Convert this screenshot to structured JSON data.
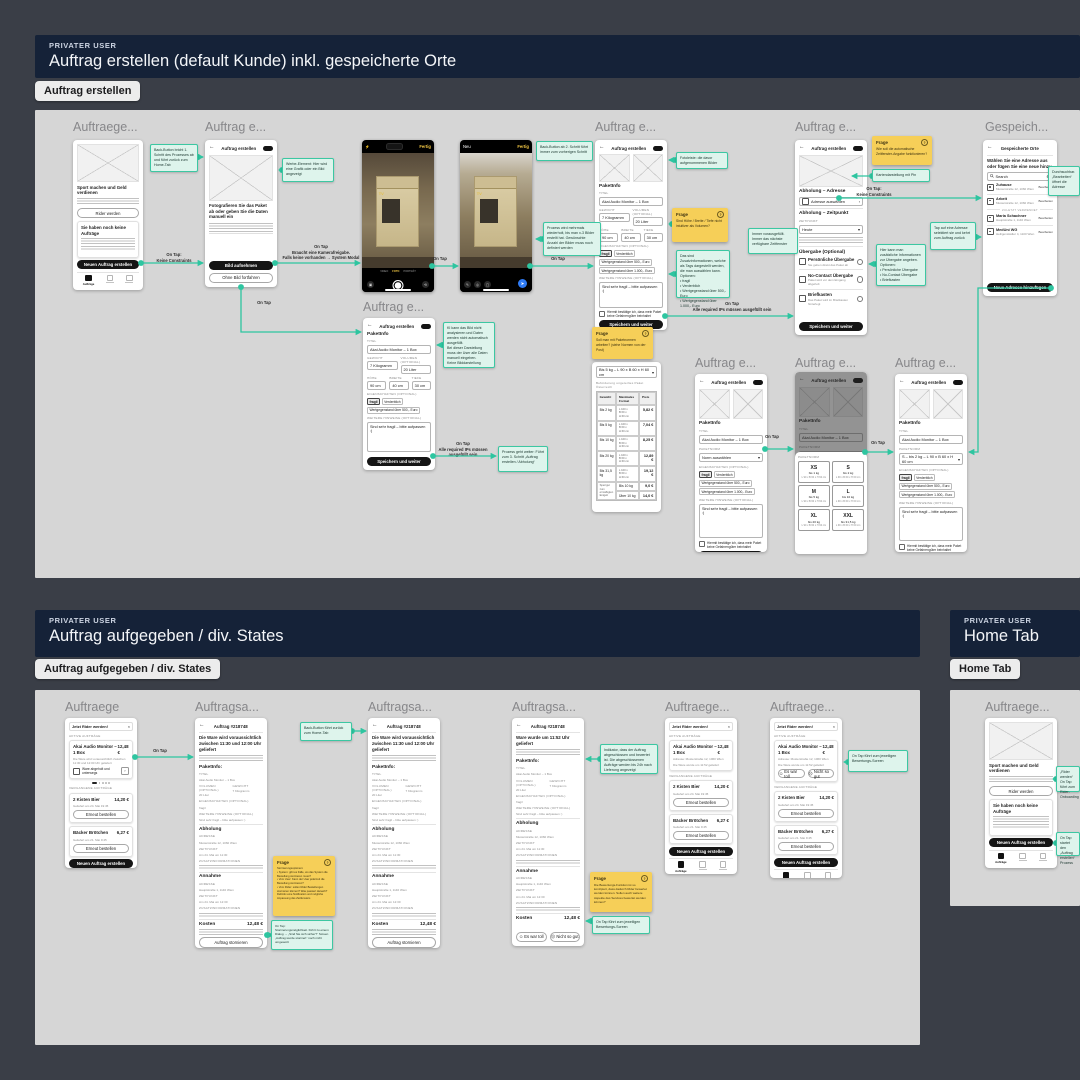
{
  "sec": {
    "s1": {
      "eyebrow": "PRIVATER USER",
      "title": "Auftrag erstellen (default Kunde) inkl. gespeicherte Orte",
      "tag": "Auftrag erstellen"
    },
    "s2": {
      "eyebrow": "PRIVATER USER",
      "title": "Auftrag aufgegeben / div. States",
      "tag": "Auftrag aufgegeben / div. States"
    },
    "s3": {
      "eyebrow": "PRIVATER USER",
      "title": "Home Tab",
      "tag": "Home Tab"
    }
  },
  "titles": {
    "auftraege_s": "Auftraege...",
    "auftraege": "Auftraege",
    "auftrag_e": "Auftrag e...",
    "auftragsa": "Auftragsa...",
    "gespeich": "Gespeich..."
  },
  "cam": {
    "fertig": "Fertig",
    "neu": "Neu",
    "foto": "FOTO",
    "video": "VIDEO",
    "portraet": "PORTRÄT",
    "send": "➤",
    "flash": "⚡"
  },
  "fr": {
    "home": {
      "hero": "Sport machen und Geld verdienen",
      "hero_btn": "Rider werden",
      "empty": "Sie haben noch keine Aufträge",
      "cta": "Neuen Auftrag erstellen",
      "tab": "Aufträge"
    },
    "foto": {
      "appbar": "Auftrag erstellen",
      "head": "Fotografieren Sie das Paket ab oder geben Sie die Daten manuell ein",
      "cta": "Bild aufnehmen",
      "alt": "Ohne Bild fortfahren"
    },
    "pk": {
      "appbar": "Auftrag erstellen",
      "sec": "PaketInfo",
      "titel_l": "TITEL",
      "titel": "Akai Audio Monitor – 1 Box",
      "gew_l": "GEWICHT",
      "gew": "7 Kilogramm",
      "vol_l": "VOLUMEN (OPTIONAL)",
      "vol": "20 Liter",
      "hoe_l": "HÖHE",
      "hoe": "90 cm",
      "bre_l": "BREITE",
      "bre": "40 cm",
      "tie_l": "TIEFE",
      "tie": "30 cm",
      "eig_l": "EIGENSCHAFTEN (OPTIONAL)",
      "chips": [
        "fragil",
        "Verderblich",
        "Wertgegenstand über 500,- Euro",
        "Wertgegenstand über 1.000,- Euro"
      ],
      "hin_l": "WEITERE HINWEISE (OPTIONAL)",
      "hin": "Sind sehr fragil – bitte aufpassen :)",
      "chk": "Hiermit bestätige ich, dass mein Paket keine Gefahrengüter beinhaltet",
      "cta": "Speichern und weiter",
      "norm_l": "PAKETNORM",
      "norm_ph": "Norm auswählen",
      "norm_sel": "S – bis 2 kg – L 90 x B 60 x H 60 cm",
      "caret": "▾",
      "chev": "›"
    },
    "sheet": {
      "lbl": "PAKETNORM",
      "cells": [
        {
          "n": "XS",
          "w": "bis 1 kg",
          "d": "L 90 x B 60 x H 60 cm"
        },
        {
          "n": "S",
          "w": "bis 2 kg",
          "d": "L 90 x B 60 x H 60 cm"
        },
        {
          "n": "M",
          "w": "bis 5 kg",
          "d": "L 90 x B 60 x H 60 cm"
        },
        {
          "n": "L",
          "w": "bis 10 kg",
          "d": "L 90 x B 60 x H 60 cm"
        },
        {
          "n": "XL",
          "w": "bis 20 kg",
          "d": "L 90 x B 60 x H 60 cm"
        },
        {
          "n": "XXL",
          "w": "bis 31,5 kg",
          "d": "L 90 x B 60 x H 60 cm"
        }
      ]
    },
    "abh": {
      "appbar": "Auftrag erstellen",
      "sec1": "Abholung – Adresse",
      "row1": "Adresse auswählen",
      "sec2": "Abholung – Zeitpunkt",
      "zeit_l": "ZEITPUNKT",
      "zeit": "Heute",
      "sec3": "Übergabe (Optional)",
      "o1": "Persönliche Übergabe",
      "o1s": "Sie geben direkt das Paket ab",
      "o2": "No-Contact Übergabe",
      "o2s": "Paket wird vor dem Eingang abgeholt",
      "o3": "Briefkasten",
      "o3s": "Das Paket wird im Briefkasten hinterlegt",
      "cta": "Speichern und weiter"
    },
    "orte": {
      "appbar": "Gespeicherte Orte",
      "intro": "Wählen Sie eine Adresse aus oder fügen Sie eine neue hinzu",
      "search": "Search",
      "edit": "Bearbeiten",
      "div": "ZULETZT VERWENDET",
      "i1n": "Zuhause",
      "i1a": "Musterstraße 12, 1060 Wien",
      "i2n": "Arbeit",
      "i2a": "Musterstraße 12, 1060 Wien",
      "i3n": "Maria Schachner",
      "i3a": "Hauptstraße 1, 1140 Wien",
      "i4n": "MedUni WG",
      "i4a": "Heiligenstädter 4, 1100 Wien",
      "cta": "Neue Adresse hinzufügen"
    },
    "tab": {
      "dd": "Bis 5 kg – L 90 x B 60 x H 60 cm",
      "cap": "Beförderung ungeteiltes Paket Österreich",
      "h1": "Gewicht",
      "h2": "Maximales Format",
      "h3": "Preis",
      "rows": [
        {
          "g": "Bis 2 kg",
          "f": "L 100 x\nB 60 x\nH 60 cm",
          "p": "5,82 €"
        },
        {
          "g": "Bis 5 kg",
          "f": "L 100 x\nB 60 x\nH 60 cm",
          "p": "7,04 €"
        },
        {
          "g": "Bis 10 kg",
          "f": "L 100 x\nB 60 x\nH 60 cm",
          "p": "8,25 €"
        },
        {
          "g": "Bis 20 kg",
          "f": "L 100 x\nB 60 x\nH 60 cm",
          "p": "12,89 €"
        },
        {
          "g": "Bis 31,5 kg",
          "f": "L 100 x\nB 60 x\nH 60 cm",
          "p": "19,12 €"
        }
      ],
      "f1": "Sperrgut zum ermäßigten Entgelt",
      "f1a": "Bis 10 kg",
      "f1p": "9,0 €",
      "f2a": "Über 10 kg",
      "f2p": "14,0 €"
    },
    "ord": {
      "banner": "Jetzt Rider werden!",
      "close": "×",
      "aktiv": "AKTIVE AUFTRÄGE",
      "t": "Akai Audio Monitor – 1 Box",
      "p": "12,48 €",
      "txt": "Die Ware wird voraussichtlich zwischen 11:30 und 12:00 Uhr geliefert",
      "addr": "Adresse: Musterstraße 12, 1060 Wien",
      "done": "Die Ware wurde um 11:52 geliefert",
      "status": "Ware abgeholt und unterwegs",
      "verg": "VERGANGENE AUFTRÄGE",
      "p1t": "2 Kisten Bier",
      "p1p": "14,20 €",
      "p1d": "Geliefert am 24. Mai 19:45",
      "p2t": "Bäcker Brötchen",
      "p2p": "6,27 €",
      "p2d": "Geliefert am 21. Mai 9:45",
      "re": "Erneut bestellen",
      "cta": "Neuen Auftrag erstellen",
      "good": "Es war toll",
      "bad": "Nicht so gut",
      "good_ic": "☺",
      "bad_ic": "☹"
    },
    "det": {
      "appbar": "Auftrag #218748",
      "head": "Die Ware wird voraussichtlich zwischen 11:30 und 12:00 Uhr geliefert",
      "head_done": "Ware wurde um 11:52 Uhr geliefert",
      "pk": "PaketInfo:",
      "abh": "Abholung",
      "ann": "Annahme",
      "adr_l": "ADRESSE",
      "zeit_l": "ZEITPUNKT",
      "zus_l": "ZUSATZINFORMATIONEN",
      "abh_a": "Musterstraße 12, 1060 Wien",
      "abh_z": "Am 24. Mai um 11:30",
      "ann_a": "Hauptstraße 1, 1140 Wien",
      "ann_z": "Am 24. Mai um 12:30",
      "kost": "Kosten",
      "kostv": "12,48 €",
      "cancel": "Auftrag stornieren",
      "eig": "fragil"
    }
  },
  "st": {
    "q1": {
      "t": "Frage",
      "q": "?",
      "b": "Sind Höhe / Breite / Tiefe nicht intuitiver als Volumen?"
    },
    "q2": {
      "t": "Frage",
      "q": "?",
      "b": "Soll man mit Paketnormen arbeiten? (siehe Normen von der Post)"
    },
    "q3": {
      "t": "Frage",
      "q": "?",
      "b": "Wie soll die automatische Zeitfenster-Angabe funktionieren?"
    },
    "q4": {
      "t": "Frage",
      "q": "?",
      "b": "Stornierungsoptionen:\n• System: gibt es Fälle, wo das System die Bestellung stornieren muss?\n• Vom User: Kann der User jederzeit die Bestellung stornieren?\n• Vom Rider: sollen Rider Bestellungen stornieren können? Was passiert danach? Definitiv eine Notification und mögliche Anpassung des Zeitfensters"
    },
    "q5": {
      "t": "Frage",
      "q": "?",
      "b": "Die Bewertungs-Funktion ist so konzipiert, dass dadurch Rider bewertet werden können. Sollen auch weitere Aspekte des Services bewertet werden können?"
    }
  },
  "nt": {
    "n1": "Back-Button bricht 1. Schritt des Prozesses ab und führt zurück zum Home-Tab",
    "n2": "Werbe-Element: Hier wird eine Grafik oder ein Bild angezeigt",
    "n3": "Back-Button ab 2. Schritt führt immer zum vorherigen Schritt",
    "n4": "Prozess wird mehrmals wiederholt, bis man x-3 Bilder erstellt hat. Gewünschte Anzahl der Bilder muss noch definiert werden",
    "n5": "Fotoleiste: die davor aufgenommenen Bilder",
    "n6": "Das sind Zusatzinformationen, welche als Tags dargestellt werden, die man auswählen kann.\nOptionen:\n• fragil\n• Verderblich\n• Wertgegenstand über 500,- Euro\n• Wertgegenstand über 1.000,- Euro",
    "n7": "Immer vorausgefüllt. Immer das nächste verfügbare Zeitfenster",
    "n8": "Kartendarstellung mit Pin",
    "n9": "Hier kann man zusätzliche Informationen zur Übergabe angeben.\nOptionen:\n• Persönliche Übergabe\n• No-Contact Übergabe\n• Briefkasten",
    "n10": "KI kann das Bild nicht analysieren und Daten werden nicht automatisch ausgefüllt.\nBei dieser Darstellung muss der User alle Daten manuell eingeben.\nKeine Bilddarstellung",
    "n11": "Prozess geht weiter: Führt zum 3. Schritt „Auftrag erstellen / Abholung“",
    "n12": "Durchsuchbar. „Bearbeiten“ öffnet die Adresse",
    "n13": "Tap auf eine Adresse selektiert sie und kehrt zum Auftrag zurück",
    "m1": "Back-Button führt zurück zum Home-Tab",
    "m2": "Indikator, dass der Auftrag abgeschlossen und bewertet ist. Die abgeschlossenen Aufträge werden bis 24h nach Lieferung angezeigt",
    "m3": "On Tap führt zum jeweiligen Bewertungs-Screen",
    "m4": "On Tap:\nStornierungsmöglichkeit. Führt zu einem Dialog → „Sind Sie sich sicher?“ Screen „Auftrag wurde storniert“ noch nicht umgesetzt",
    "m6": "On Tap führt zum jeweiligen Bewertungs-Screen",
    "o1": "„Rider werden“ On Tap führt zum Rider-Onboarding",
    "o2": "On Tap startet den „Auftrag erstellen“ Prozess"
  },
  "lb": {
    "ontap": "On Tap",
    "keine": "On Tap:\nKeine Constraints",
    "cam": "On Tap\nBraucht eine Kamerafreigabe.\nFalls keine vorhanden → System Modal",
    "req": "On Tap\nAlle required IPs müssen ausgefüllt sein"
  },
  "colors": {
    "connector": "#2ec5a0",
    "sticky_yellow": "#f6cf58",
    "note_teal": "#def4ec",
    "header_navy": "#152238",
    "canvas": "#d6d6d6",
    "bg": "#3a3e47"
  }
}
